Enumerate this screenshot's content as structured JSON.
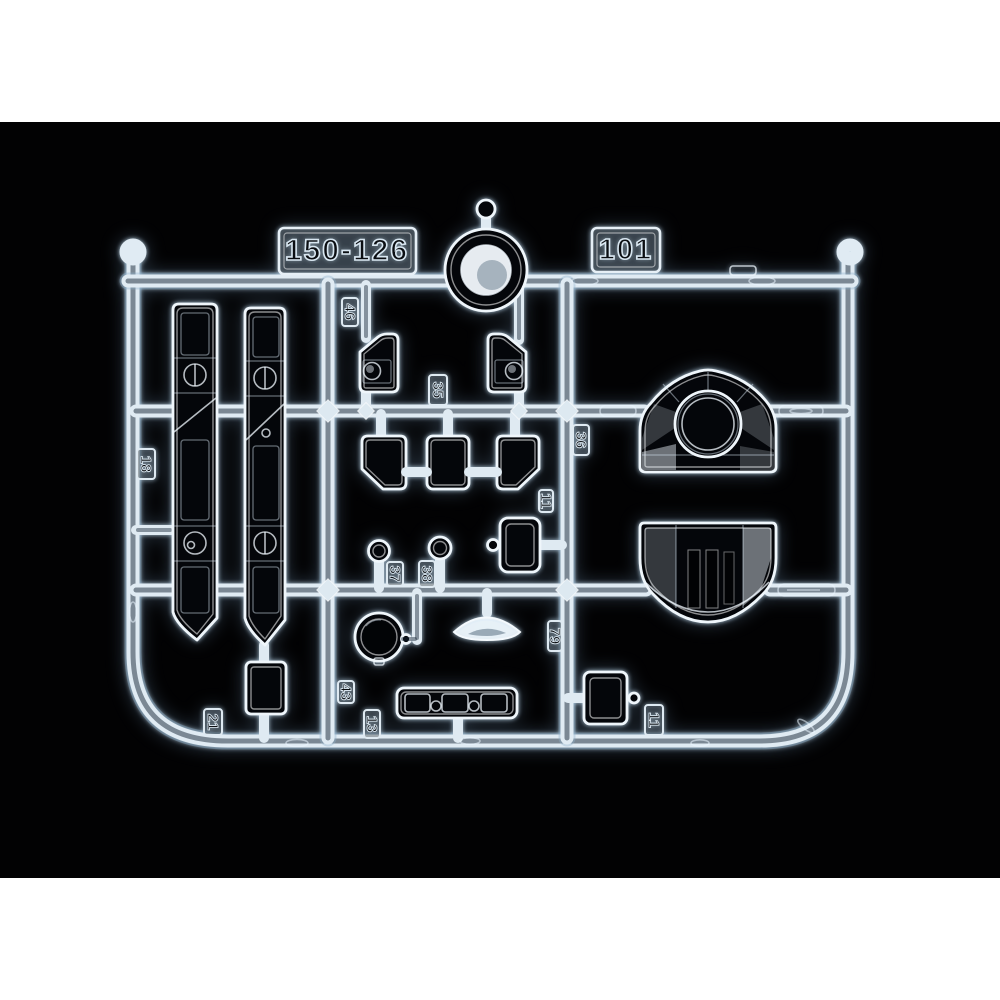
{
  "photo": {
    "type": "clear-parts-sprue-product-photo",
    "background_color": "#020203",
    "canvas_color": "#ffffff",
    "plastic_color": "#e8f1f7"
  },
  "sprue": {
    "plates": [
      "150-126",
      "101"
    ],
    "tags": [
      "18",
      "46",
      "35",
      "36",
      "11",
      "37",
      "38",
      "79",
      "43",
      "13",
      "21",
      "11"
    ]
  }
}
